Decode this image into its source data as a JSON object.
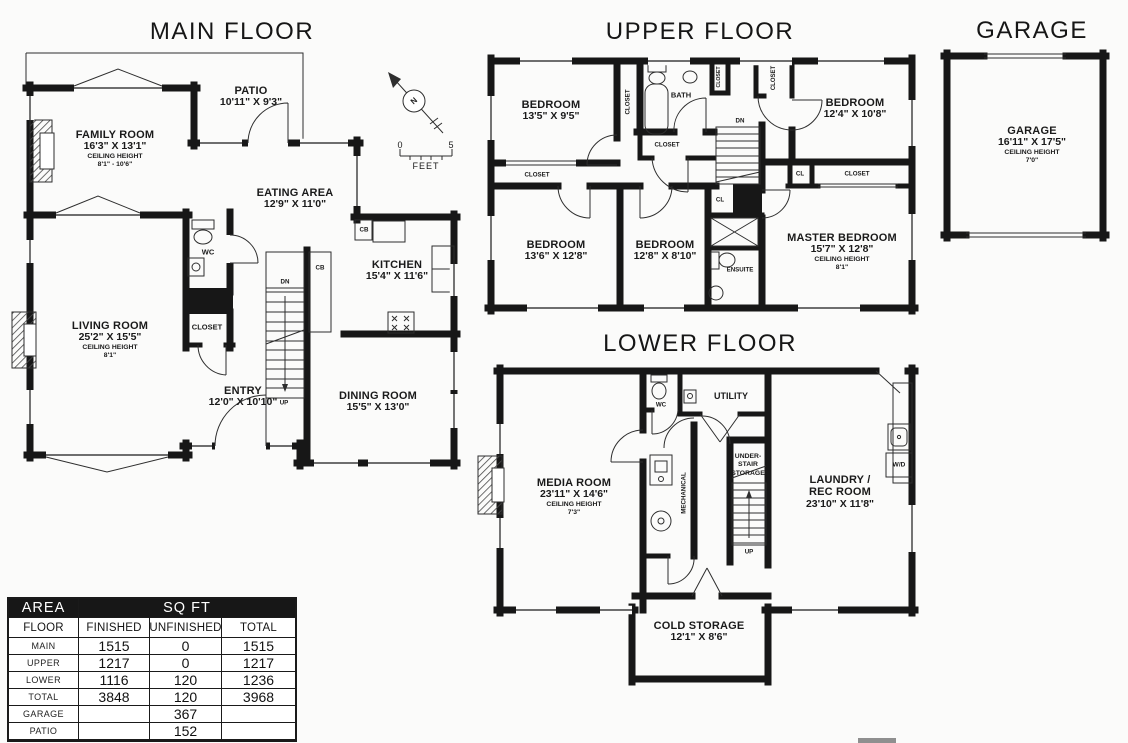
{
  "titles": {
    "main_floor": "MAIN FLOOR",
    "upper_floor": "UPPER FLOOR",
    "garage": "GARAGE",
    "lower_floor": "LOWER FLOOR"
  },
  "compass": {
    "north": "N"
  },
  "scale": {
    "zero": "0",
    "five": "5",
    "unit": "FEET"
  },
  "main_floor": {
    "family_room": {
      "name": "FAMILY ROOM",
      "dims": "16'3\" X 13'1\"",
      "ceiling_label": "CEILING HEIGHT",
      "ceiling": "8'1\" - 10'6\""
    },
    "patio": {
      "name": "PATIO",
      "dims": "10'11\" X 9'3\""
    },
    "eating_area": {
      "name": "EATING AREA",
      "dims": "12'9\" X 11'0\""
    },
    "kitchen": {
      "name": "KITCHEN",
      "dims": "15'4\" X 11'6\""
    },
    "living_room": {
      "name": "LIVING ROOM",
      "dims": "25'2\" X 15'5\"",
      "ceiling_label": "CEILING HEIGHT",
      "ceiling": "8'1\""
    },
    "entry": {
      "name": "ENTRY",
      "dims": "12'0\" X 10'10\""
    },
    "dining_room": {
      "name": "DINING ROOM",
      "dims": "15'5\" X 13'0\""
    },
    "wc": "WC",
    "closet": "CLOSET",
    "dn": "DN",
    "up": "UP",
    "cb": "CB"
  },
  "upper_floor": {
    "bedroom1": {
      "name": "BEDROOM",
      "dims": "13'5\" X 9'5\""
    },
    "bedroom2": {
      "name": "BEDROOM",
      "dims": "12'4\" X 10'8\""
    },
    "bedroom3": {
      "name": "BEDROOM",
      "dims": "13'6\" X 12'8\""
    },
    "bedroom4": {
      "name": "BEDROOM",
      "dims": "12'8\" X 8'10\""
    },
    "master_bedroom": {
      "name": "MASTER BEDROOM",
      "dims": "15'7\" X 12'8\"",
      "ceiling_label": "CEILING HEIGHT",
      "ceiling": "8'1\""
    },
    "bath": "BATH",
    "ensuite": "ENSUITE",
    "closet": "CLOSET",
    "cl": "CL",
    "dn": "DN"
  },
  "garage": {
    "room": {
      "name": "GARAGE",
      "dims": "16'11\" X 17'5\"",
      "ceiling_label": "CEILING HEIGHT",
      "ceiling": "7'0\""
    }
  },
  "lower_floor": {
    "media_room": {
      "name": "MEDIA ROOM",
      "dims": "23'11\" X 14'6\"",
      "ceiling_label": "CEILING HEIGHT",
      "ceiling": "7'3\""
    },
    "cold_storage": {
      "name": "COLD STORAGE",
      "dims": "12'1\" X 8'6\""
    },
    "laundry": {
      "line1": "LAUNDRY /",
      "line2": "REC ROOM",
      "dims": "23'10\" X 11'8\""
    },
    "understair": {
      "line1": "UNDER-",
      "line2": "STAIR",
      "line3": "STORAGE"
    },
    "utility": "UTILITY",
    "wc": "WC",
    "mechanical": "MECHANICAL",
    "wd": "W/D",
    "up": "UP"
  },
  "area_table": {
    "header_area": "AREA",
    "header_sqft": "SQ FT",
    "columns": [
      "FLOOR",
      "FINISHED",
      "UNFINISHED",
      "TOTAL"
    ],
    "rows": [
      {
        "floor": "MAIN",
        "finished": "1515",
        "unfinished": "0",
        "total": "1515"
      },
      {
        "floor": "UPPER",
        "finished": "1217",
        "unfinished": "0",
        "total": "1217"
      },
      {
        "floor": "LOWER",
        "finished": "1116",
        "unfinished": "120",
        "total": "1236"
      },
      {
        "floor": "TOTAL",
        "finished": "3848",
        "unfinished": "120",
        "total": "3968"
      },
      {
        "floor": "GARAGE",
        "finished": "",
        "unfinished": "367",
        "total": ""
      },
      {
        "floor": "PATIO",
        "finished": "",
        "unfinished": "152",
        "total": ""
      }
    ]
  }
}
